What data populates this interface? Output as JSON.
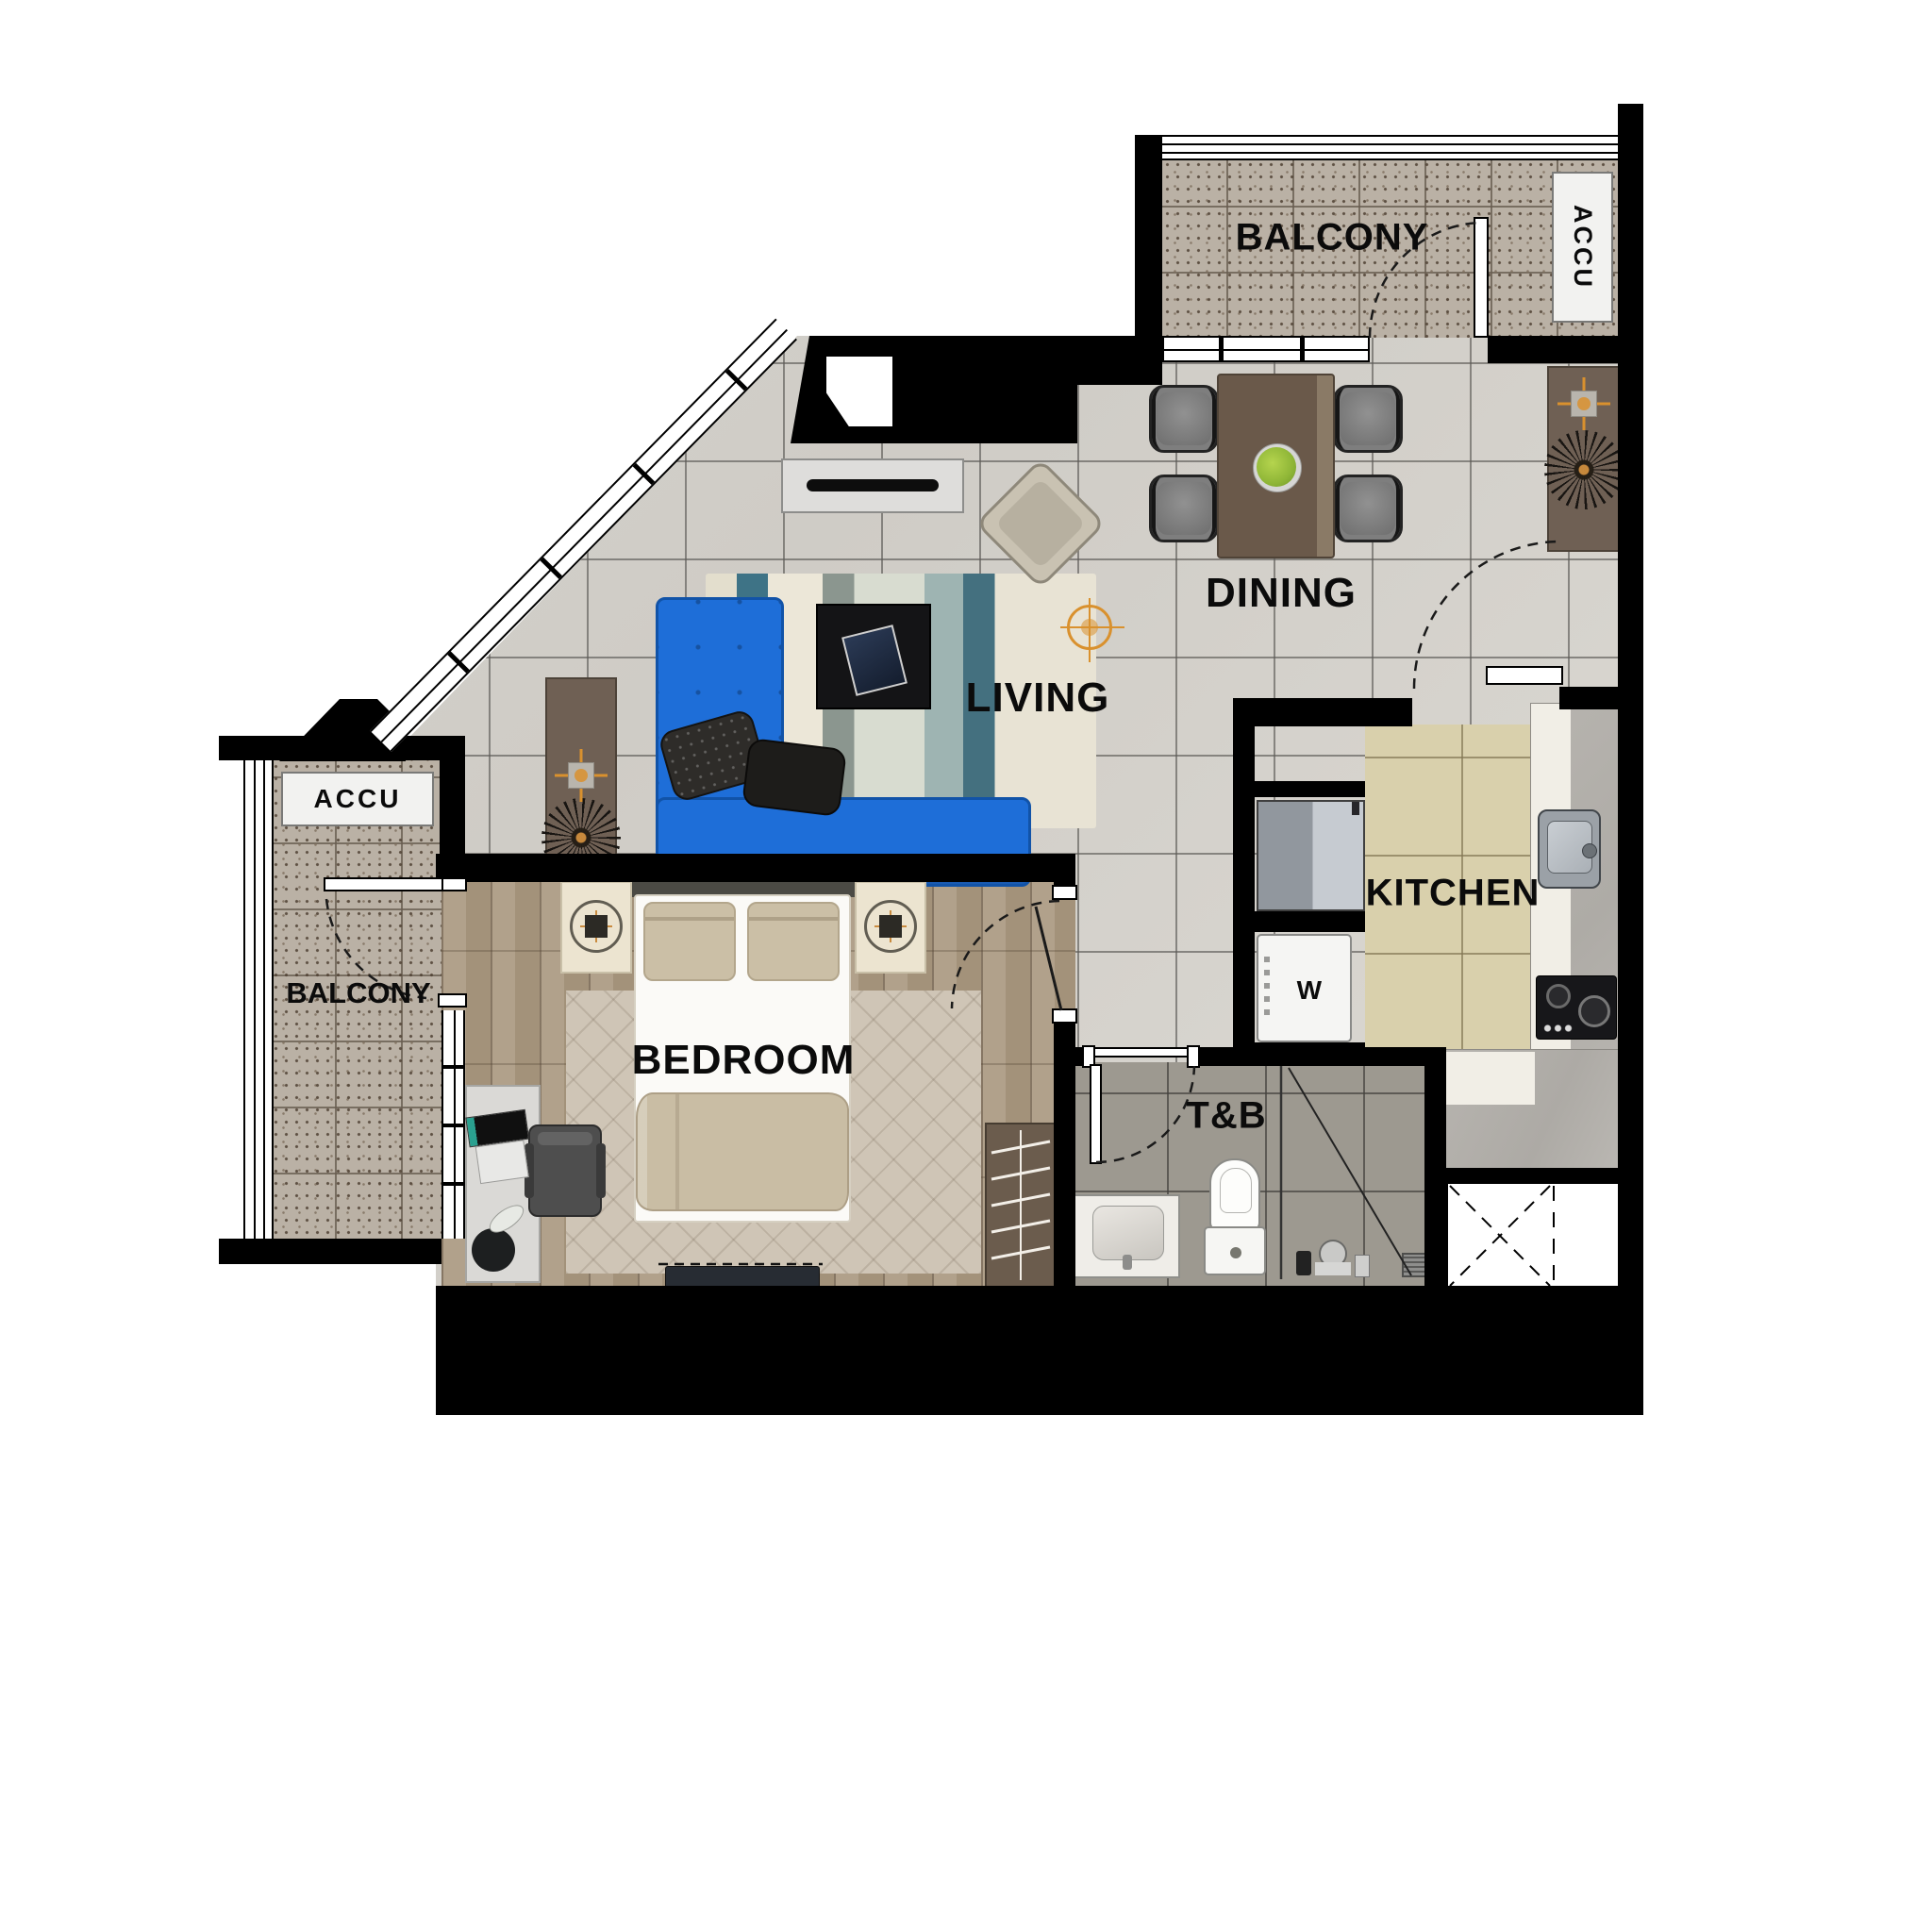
{
  "labels": {
    "balcony_top": "BALCONY",
    "accu_top": "ACCU",
    "dining": "DINING",
    "living": "LIVING",
    "kitchen": "KITCHEN",
    "bedroom": "BEDROOM",
    "toilet_bath": "T&B",
    "washer": "W",
    "balcony_left": "BALCONY",
    "accu_left": "ACCU"
  },
  "colors": {
    "wall": "#000000",
    "sofa_blue": "#1e6ed8",
    "dining_table_brown": "#6a594a",
    "console_brown": "#6f6054",
    "chair_gray": "#7e7e7e",
    "tile_gray": "#d2cfc9",
    "balcony_speckle": "#bab1a5",
    "wood_floor": "#a9987f",
    "kitchen_tile": "#d9d0ac",
    "tb_tile": "#9d9990",
    "counter_gray": "#b3b0ab",
    "counter_white": "#f1eee6",
    "accent_orange": "#d9912e",
    "rug_teal": "#3e7386",
    "bed_linen": "#fbfaf7",
    "blanket_tan": "#c9bda4"
  },
  "symbols": [
    "door-swing-arc",
    "ceiling-light-crosshair",
    "starburst-decor",
    "shaft-cross-box",
    "shower-drain",
    "wardrobe-hangers"
  ]
}
